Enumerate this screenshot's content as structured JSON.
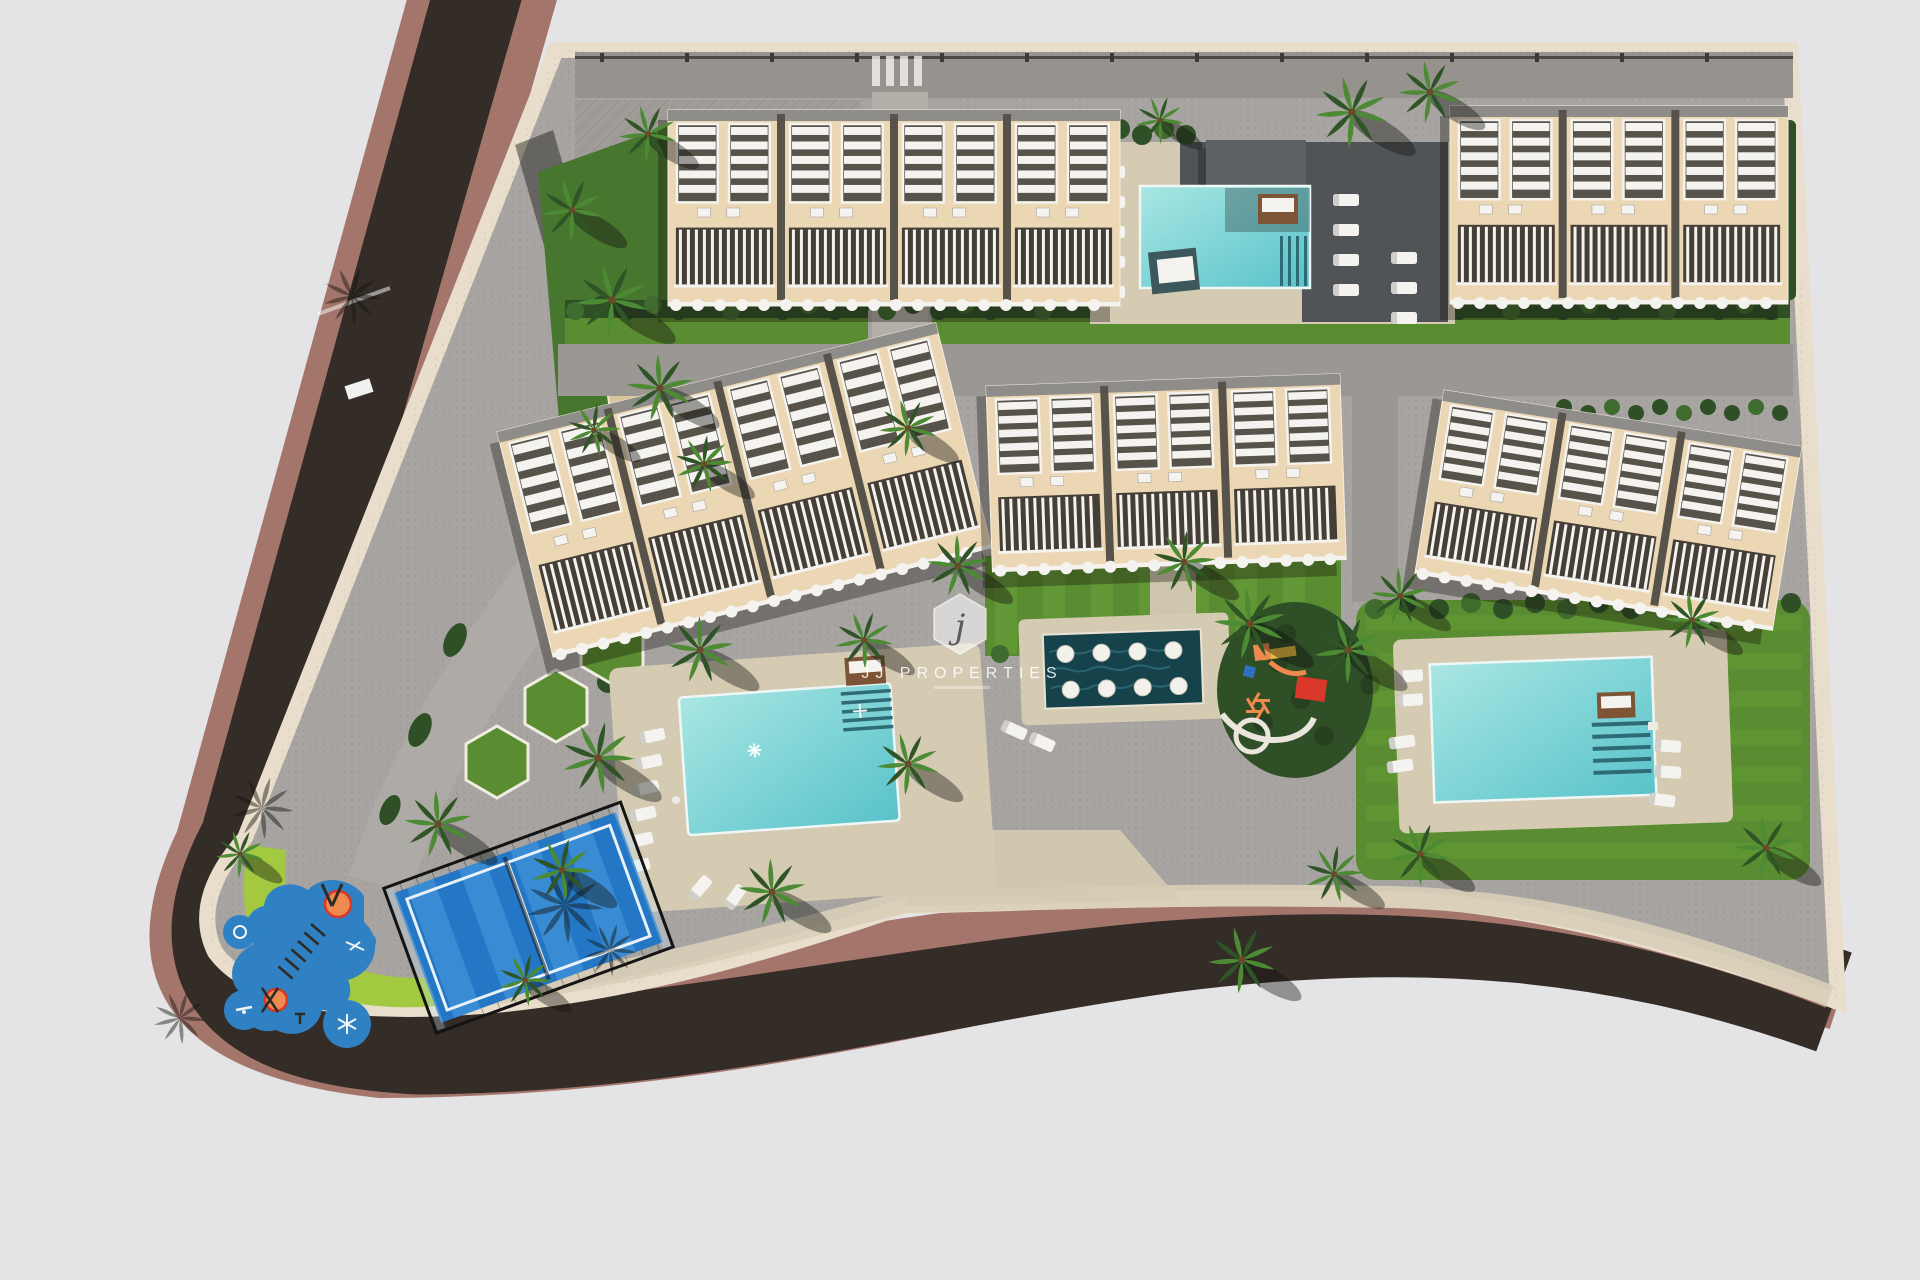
{
  "scene_type": "architectural-aerial-render",
  "watermark": {
    "logo_letter": "j",
    "brand": "JJ PROPERTIES"
  },
  "colors": {
    "bg": "#e4e4e6",
    "road": "#342c27",
    "sidewalk": "#a3756b",
    "curb": "#e9decb",
    "paving": "#a7a4a1",
    "paving_top": "#96938f",
    "path": "#9b9894",
    "path_light": "#b3aea8",
    "deck": "#d5cbb3",
    "deck_dark": "#515457",
    "canopy": "#5f6265",
    "building": "#ecd7b4",
    "building_gap": "#57524a",
    "roof": "#8f8d89",
    "pergola": "#f4f3ef",
    "balcony": "#453f37",
    "hedge": "#2f4f27",
    "hedge_light": "#3f6b2f",
    "grass": "#5a8c31",
    "grass_light": "#6aa23a",
    "grass_bright": "#a2c93f",
    "garden": "#47762e",
    "sand": "#d9c59b",
    "palm_dark": "#2f5426",
    "palm_light": "#4c8a33",
    "trunk": "#6b4a2a",
    "pool_light": "#a9e6e3",
    "pool_deep": "#58c3ca",
    "pool_steps": "#2e6b74",
    "feature_water": "#16424b",
    "feature_ripple": "#2e6f77",
    "court": "#2377c4",
    "court_light": "#3d8ed6",
    "court_line": "#e8f0f8",
    "fence": "#141414",
    "splash": "#2f81c4",
    "splash_dark": "#1e5d9a",
    "orange": "#ef8a4e",
    "red": "#d8372a",
    "yellow": "#e9b93c",
    "blue_item": "#2e6fc0",
    "lounger": "#f4f3ef",
    "daybed": "#7d5536",
    "shadow": "rgba(22,19,15,0.35)",
    "tree_shadow": "rgba(18,18,14,0.40)",
    "wall_shadow": "rgba(24,24,20,0.45)",
    "wm_fill": "rgba(255,255,255,0.55)",
    "wm_text": "rgba(255,255,255,0.85)",
    "wm_letter": "rgba(60,60,60,0.80)"
  },
  "elements": [
    {
      "name": "perimeter-road"
    },
    {
      "name": "sidewalk"
    },
    {
      "name": "townhouse-block-north-west"
    },
    {
      "name": "townhouse-block-north-east"
    },
    {
      "name": "townhouse-block-west"
    },
    {
      "name": "townhouse-block-center"
    },
    {
      "name": "townhouse-block-east"
    },
    {
      "name": "north-swimming-pool"
    },
    {
      "name": "main-swimming-pool"
    },
    {
      "name": "east-swimming-pool"
    },
    {
      "name": "reflective-water-feature"
    },
    {
      "name": "children-playground"
    },
    {
      "name": "splash-water-playground"
    },
    {
      "name": "paddle-tennis-court"
    },
    {
      "name": "palm-trees"
    },
    {
      "name": "lawns-and-hedges"
    },
    {
      "name": "watermark-logo"
    }
  ]
}
